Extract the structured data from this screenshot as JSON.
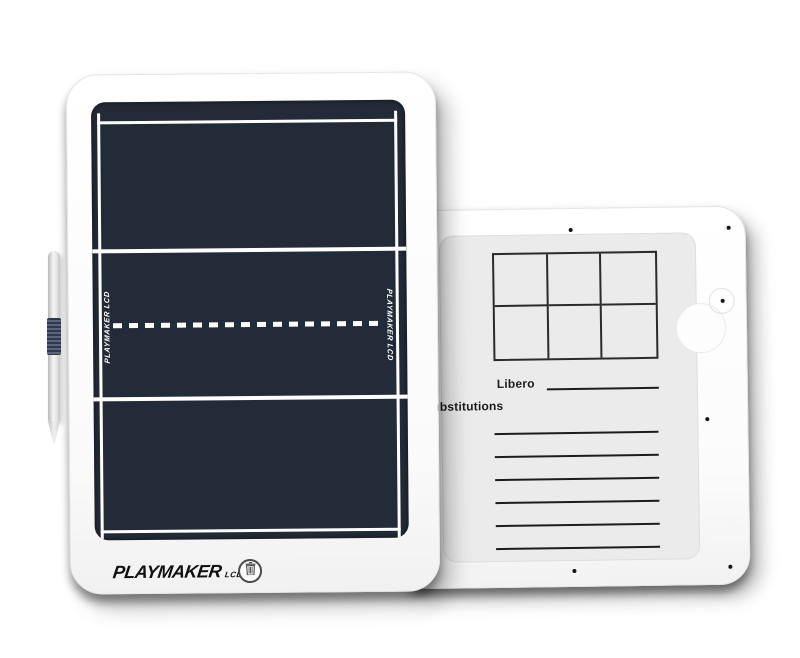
{
  "product": {
    "name": "Playmaker LCD volleyball coaching tablet, front and back view",
    "front": {
      "brand": "PLAYMAKER",
      "brand_suffix": "LCD",
      "side_label": "PLAYMAKER LCD",
      "erase_icon": "trash-icon",
      "screen_content": "volleyball court: outer boundary, two attack lines, dashed center net line"
    },
    "back": {
      "libero_label": "Libero",
      "substitutions_label": "Substitutions",
      "lineup_grid": {
        "rows": 2,
        "columns": 3
      },
      "note_line_count": 6,
      "screw_count": 6
    },
    "stylus": "silver stylus with dark ribbed grip"
  },
  "colors": {
    "background": "#ffffff",
    "tablet_body": "#ffffff",
    "screen": "#232b38",
    "court_line": "#ffffff",
    "insert_panel": "#ebebeb",
    "ink": "#1c1c1c",
    "stylus_grip": "#2f3848"
  }
}
